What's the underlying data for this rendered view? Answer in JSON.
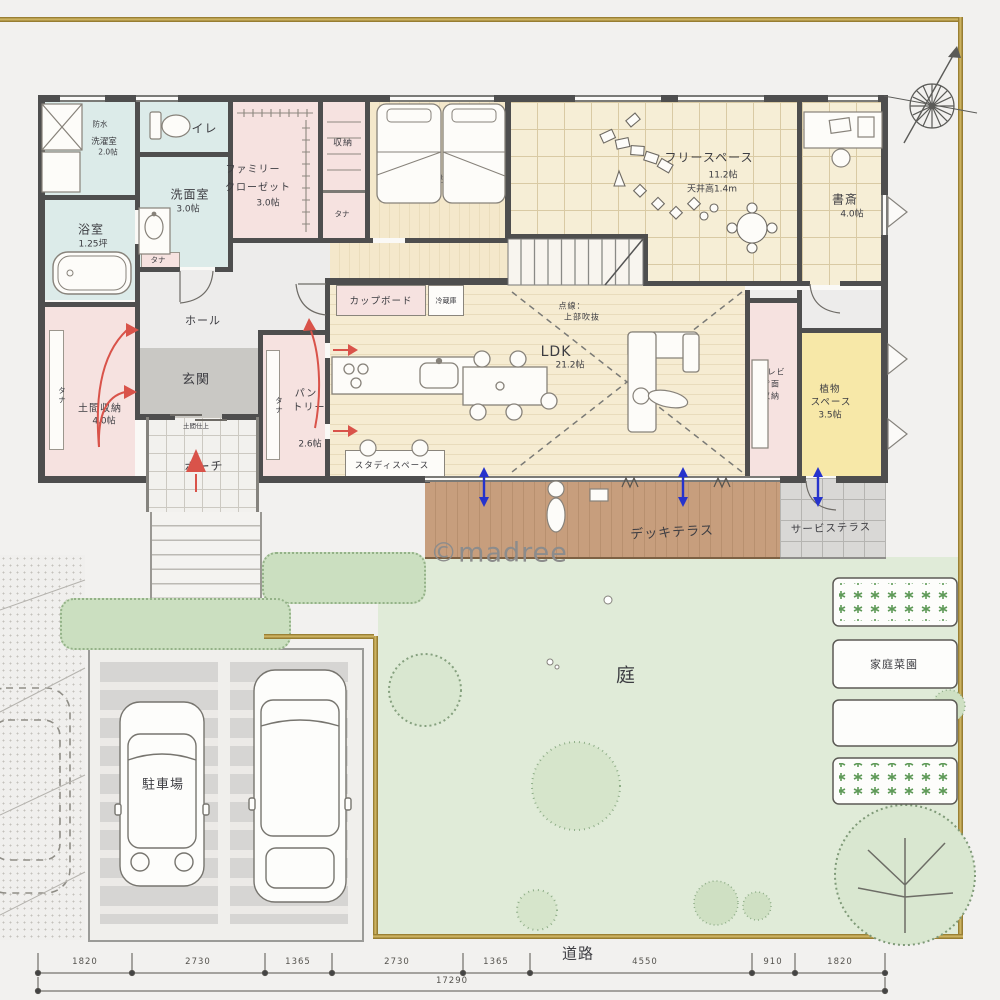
{
  "palette": {
    "paper": "#f2f1ef",
    "gold_frame": "#b0923f",
    "wall": "#4e4e4e",
    "wet_room": "#dcebe9",
    "storage_pink": "#f6e2e0",
    "wood_floor": "#f3e7c9",
    "grid_floor": "#f6eed6",
    "yellow_room": "#f7e8a8",
    "deck_wood": "#c49a77",
    "garden_green": "#e0ebd8",
    "flow_arrow_red": "#d9534a",
    "vent_arrow_blue": "#2633cc"
  },
  "meta": {
    "watermark": "©madree"
  },
  "labels": {
    "shelf": "タナ"
  },
  "rooms": {
    "laundry": {
      "name": "洗濯室",
      "size": "2.0帖",
      "washer": "洗濯機",
      "waterproof": "防水",
      "counter": "作業台",
      "under_storage": "下部収納"
    },
    "toilet": {
      "name": "トイレ"
    },
    "washroom": {
      "name": "洗面室",
      "size": "3.0帖"
    },
    "bath": {
      "name": "浴室",
      "size": "1.25坪"
    },
    "family_closet": {
      "l1": "ファミリー",
      "l2": "クローゼット",
      "size": "3.0帖"
    },
    "closet": {
      "name": "収納"
    },
    "bedroom": {
      "name": "寝室",
      "size": "6.6帖"
    },
    "free_space": {
      "name": "フリースペース",
      "size": "11.2帖",
      "note": "天井高1.4m"
    },
    "study": {
      "name": "書斎",
      "size": "4.0帖"
    },
    "hall": {
      "name": "ホール"
    },
    "entrance": {
      "name": "玄関",
      "floor_note": "土間仕上"
    },
    "doma": {
      "name": "土間収納",
      "size": "4.0帖"
    },
    "porch": {
      "name": "ポーチ"
    },
    "pantry": {
      "l1": "パン",
      "l2": "トリー",
      "size": "2.6帖"
    },
    "cupboard": {
      "name": "カップボード"
    },
    "fridge": {
      "name": "冷蔵庫"
    },
    "ldk": {
      "name": "LDK",
      "size": "21.2帖",
      "void_note1": "点線：",
      "void_note2": "上部吹抜"
    },
    "study_space": {
      "name": "スタディスペース"
    },
    "tv_storage": {
      "l1": "テレビ",
      "l2": "背面",
      "l3": "収納"
    },
    "plant_space": {
      "l1": "植物",
      "l2": "スペース",
      "size": "3.5帖"
    },
    "deck": {
      "name": "デッキテラス"
    },
    "service_terrace": {
      "name": "サービステラス"
    },
    "garden": {
      "name": "庭"
    },
    "veg_garden": {
      "name": "家庭菜園"
    },
    "parking": {
      "name": "駐車場"
    },
    "road": {
      "name": "道路"
    }
  },
  "dimensions": {
    "segments": [
      "1820",
      "2730",
      "1365",
      "2730",
      "1365",
      "4550",
      "910",
      "1820"
    ],
    "total": "17290"
  }
}
